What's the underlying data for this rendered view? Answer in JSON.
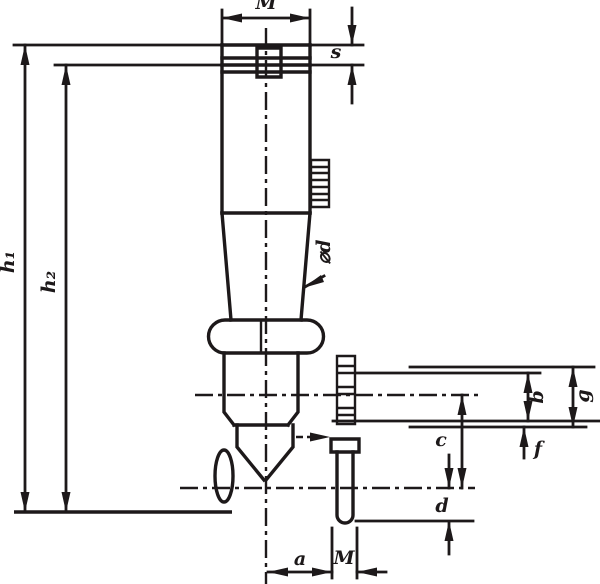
{
  "drawing": {
    "kind": "technical-dimension-drawing",
    "ink_color": "#1d191a",
    "background_color": "#ffffff",
    "dimension_labels": [
      {
        "id": "dim-label-m-top",
        "text": "M",
        "x": 266,
        "y": 9,
        "rotate": 0
      },
      {
        "id": "dim-label-s",
        "text": "s",
        "x": 336,
        "y": 58,
        "rotate": 0
      },
      {
        "id": "dim-label-h1",
        "text": "h₁",
        "x": 14,
        "y": 262,
        "rotate": -90
      },
      {
        "id": "dim-label-h2",
        "text": "h₂",
        "x": 55,
        "y": 282,
        "rotate": -90
      },
      {
        "id": "dim-label-d-diameter",
        "text": "⌀d",
        "x": 330,
        "y": 252,
        "rotate": -90
      },
      {
        "id": "dim-label-b",
        "text": "b",
        "x": 543,
        "y": 397,
        "rotate": -90
      },
      {
        "id": "dim-label-g",
        "text": "g",
        "x": 589,
        "y": 396,
        "rotate": -90
      },
      {
        "id": "dim-label-f",
        "text": "f",
        "x": 538,
        "y": 455,
        "rotate": 0
      },
      {
        "id": "dim-label-c",
        "text": "c",
        "x": 441,
        "y": 446,
        "rotate": 0
      },
      {
        "id": "dim-label-d-small",
        "text": "d",
        "x": 442,
        "y": 512,
        "rotate": 0
      },
      {
        "id": "dim-label-a",
        "text": "a",
        "x": 300,
        "y": 565,
        "rotate": 0
      },
      {
        "id": "dim-label-m-pin",
        "text": "M",
        "x": 344,
        "y": 564,
        "rotate": 0
      }
    ]
  }
}
